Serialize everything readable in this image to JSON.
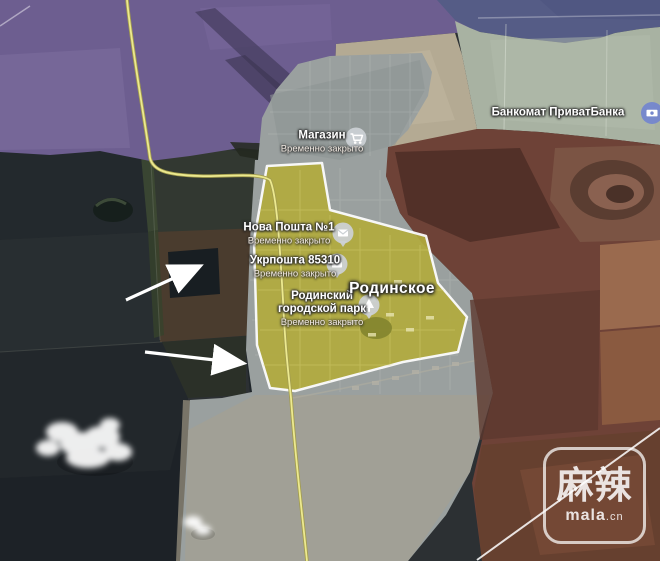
{
  "town": {
    "name": "Родинское"
  },
  "pois": [
    {
      "name": "Магазин",
      "status": "Временно закрыто",
      "marker": "shop"
    },
    {
      "name": "Нова Пошта №1",
      "status": "Временно закрыто",
      "marker": "post"
    },
    {
      "name": "Укрпошта 85310",
      "status": "Временно закрыто",
      "marker": "post"
    },
    {
      "name": "Родинский городской парк",
      "status": "Временно закрыто",
      "marker": "park"
    },
    {
      "name": "Банкомат ПриватБанка",
      "status": "",
      "marker": "atm"
    }
  ],
  "zones": {
    "purple": {
      "color": "#6d5e90"
    },
    "navy": {
      "color": "#555c86"
    },
    "sage": {
      "color": "#a8b2a2"
    },
    "red": {
      "color": "#6e4237"
    },
    "city": {
      "color": "#9aa09f"
    },
    "yellow": {
      "color": "#b2ab3e",
      "border": "#ffffff"
    },
    "road": {
      "color": "#ece98f"
    },
    "marker_blue": {
      "color": "#7486cd"
    },
    "arrow": {
      "color": "#ffffff"
    }
  },
  "watermark": {
    "cjk": "麻辣",
    "latin": "mala",
    "tld": ".cn"
  }
}
